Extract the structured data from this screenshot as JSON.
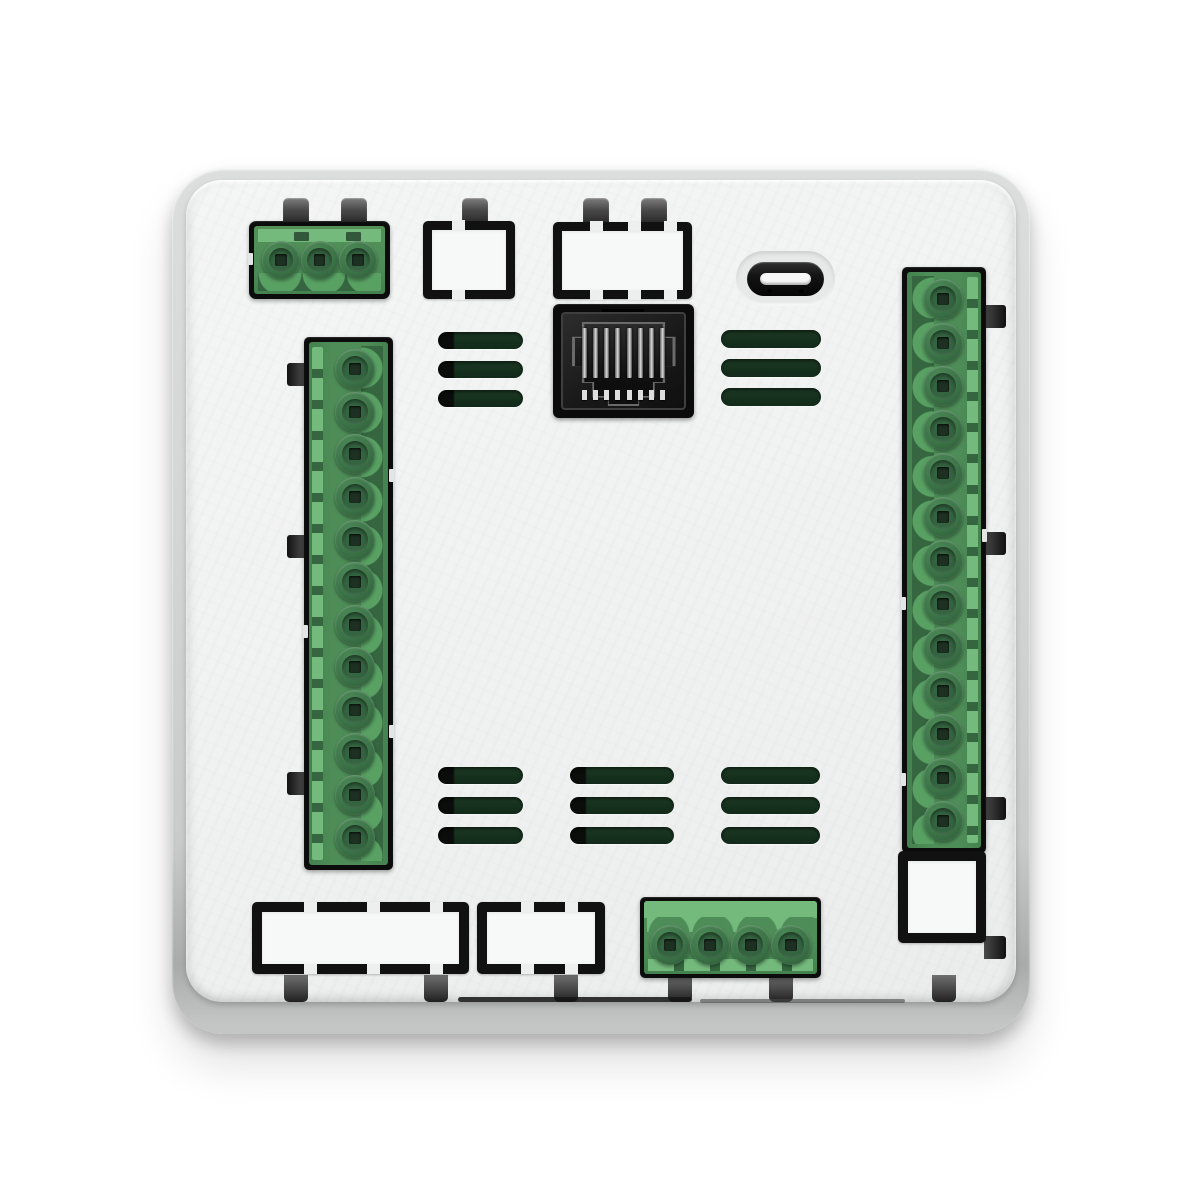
{
  "meta": {
    "type": "product-photo",
    "subject": "Rear panel of a wall-mount controller module with plug-in terminal blocks, Ethernet and USB-C ports",
    "orientation": "back view, flat on white background"
  },
  "colors": {
    "page_bg": "#ffffff",
    "frame": "#cdcfcf",
    "panel": "#f1f2f2",
    "green_body": "#4e8d58",
    "green_light": "#74ba7c",
    "green_dark": "#35663f",
    "green_scallop": "#58a163",
    "vent_green": "#132c1b",
    "port_black": "#0d0d0d",
    "metal_pin": "#d9d9d9"
  },
  "components": {
    "terminal_top_left": {
      "name": "3-pin plug-in terminal block",
      "pins": 3
    },
    "terminal_left": {
      "name": "12-pin plug-in terminal block",
      "pins": 12
    },
    "terminal_right": {
      "name": "13-pin plug-in terminal block",
      "pins": 13
    },
    "terminal_bottom": {
      "name": "4-pin plug-in terminal block",
      "pins": 4
    },
    "ethernet_port": {
      "name": "RJ45 Ethernet jack",
      "pins": 8
    },
    "usb_port": {
      "name": "USB-C port"
    },
    "cutouts": {
      "top_small": {
        "name": "rectangular knockout"
      },
      "top_wide": {
        "name": "rectangular knockout"
      },
      "right_bottom": {
        "name": "rectangular knockout"
      },
      "bottom_left": {
        "name": "expansion slot knockout"
      },
      "bottom_center": {
        "name": "expansion slot knockout"
      }
    },
    "vents": {
      "name": "ventilation slots",
      "groups": 5,
      "slots_per_group": 3
    },
    "clips": {
      "name": "mounting clip"
    }
  }
}
